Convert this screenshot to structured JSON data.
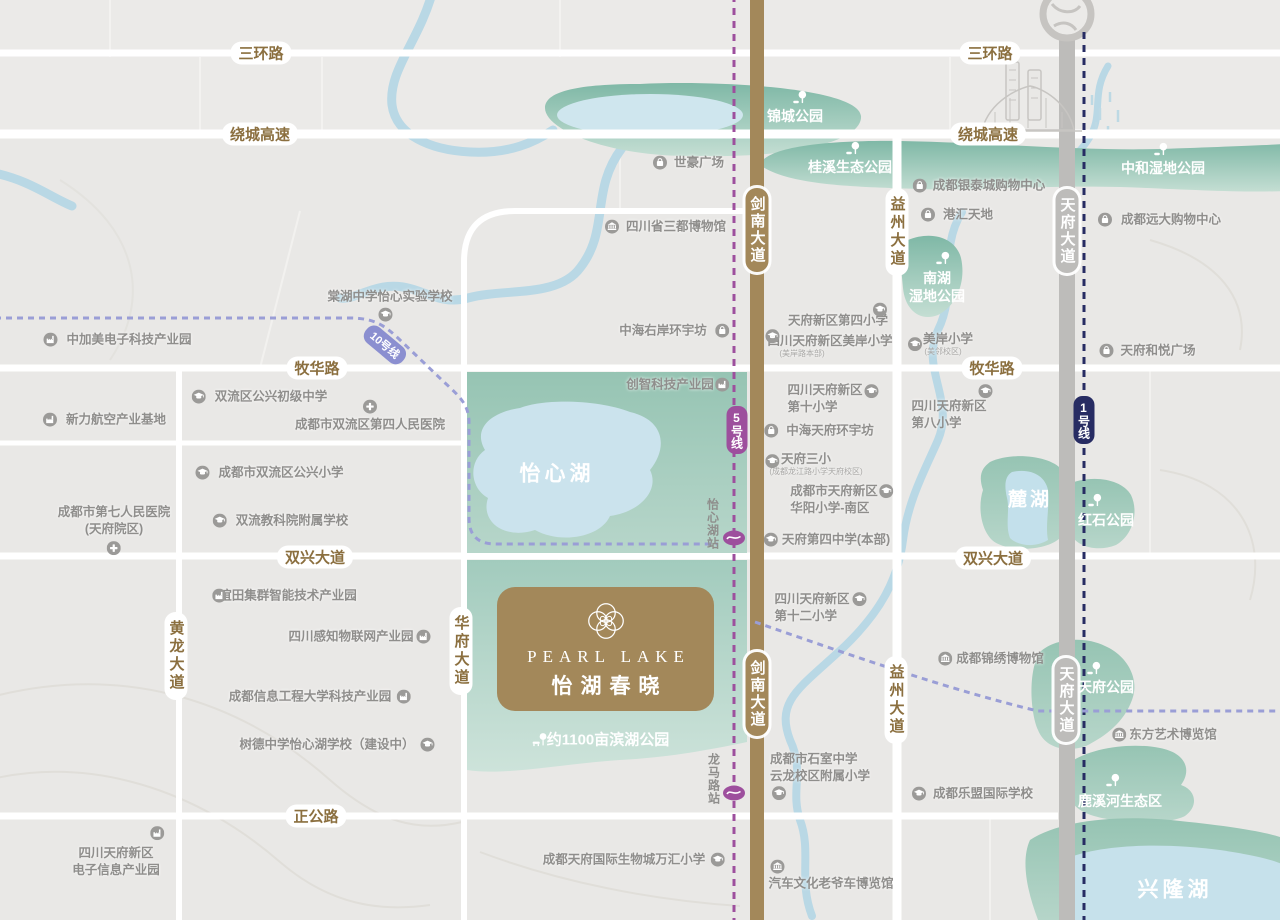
{
  "colors": {
    "background": "#e9e8e6",
    "road_white": "#ffffff",
    "avenue_brown": "#a3885a",
    "avenue_gray": "#bdbcba",
    "river": "#b9d8e5",
    "park_dark": "#7fb8a6",
    "park_light": "#c8e0d7",
    "lake": "#c9e2ec",
    "road_label_brown": "#8b6f3f",
    "poi_gray": "#8f8e8c",
    "metro_line5": "#9d4f9d",
    "metro_line1": "#272c63",
    "metro_line10": "#8b8fd0",
    "logo_bg": "#a3885a"
  },
  "logo": {
    "en": "PEARL LAKE",
    "cn": "怡湖春晓"
  },
  "road_labels": [
    {
      "text": "三环路",
      "x": 261,
      "y": 53,
      "o": "h"
    },
    {
      "text": "三环路",
      "x": 990,
      "y": 53,
      "o": "h"
    },
    {
      "text": "绕城高速",
      "x": 260,
      "y": 134,
      "o": "h"
    },
    {
      "text": "绕城高速",
      "x": 988,
      "y": 134,
      "o": "h"
    },
    {
      "text": "牧华路",
      "x": 317,
      "y": 368,
      "o": "h"
    },
    {
      "text": "牧华路",
      "x": 992,
      "y": 368,
      "o": "h"
    },
    {
      "text": "双兴大道",
      "x": 315,
      "y": 557,
      "o": "h"
    },
    {
      "text": "双兴大道",
      "x": 993,
      "y": 558,
      "o": "h"
    },
    {
      "text": "正公路",
      "x": 316,
      "y": 816,
      "o": "h"
    },
    {
      "text": "黄龙大道",
      "x": 176,
      "y": 656,
      "o": "v"
    },
    {
      "text": "华府大道",
      "x": 461,
      "y": 651,
      "o": "v"
    },
    {
      "text": "益州大道",
      "x": 897,
      "y": 232,
      "o": "v"
    },
    {
      "text": "益州大道",
      "x": 896,
      "y": 700,
      "o": "v"
    },
    {
      "text": "剑南大道",
      "x": 757,
      "y": 230,
      "o": "v",
      "road": "brown"
    },
    {
      "text": "剑南大道",
      "x": 757,
      "y": 694,
      "o": "v",
      "road": "brown"
    },
    {
      "text": "天府大道",
      "x": 1067,
      "y": 231,
      "o": "v",
      "road": "gray"
    },
    {
      "text": "天府大道",
      "x": 1066,
      "y": 700,
      "o": "v",
      "road": "gray"
    }
  ],
  "metro": {
    "badges": [
      {
        "text": "5号线",
        "x": 737,
        "y": 430,
        "color": "#9d4f9d",
        "mode": "v"
      },
      {
        "text": "1号线",
        "x": 1084,
        "y": 420,
        "color": "#272c63",
        "mode": "v"
      },
      {
        "text": "10号线",
        "x": 385,
        "y": 345,
        "color": "#8b8fd0",
        "mode": "rot",
        "rotate": 40
      }
    ],
    "stations": [
      {
        "name": "怡心湖站",
        "x": 734,
        "y": 538,
        "label_x": 713,
        "label_y": 524
      },
      {
        "name": "龙马路站",
        "x": 734,
        "y": 793,
        "label_x": 714,
        "label_y": 779
      }
    ]
  },
  "park_labels": [
    {
      "lines": [
        "锦城公园"
      ],
      "x": 795,
      "y": 116,
      "icon": "tree",
      "idx": 5,
      "idy": -18
    },
    {
      "lines": [
        "桂溪生态公园"
      ],
      "x": 850,
      "y": 167,
      "icon": "tree",
      "idx": 3,
      "idy": -18
    },
    {
      "lines": [
        "中和湿地公园"
      ],
      "x": 1163,
      "y": 168,
      "icon": "tree",
      "idx": -2,
      "idy": -18
    },
    {
      "lines": [
        "南湖",
        "湿地公园"
      ],
      "x": 937,
      "y": 287,
      "icon": "tree",
      "idx": 6,
      "idy": -28,
      "size": "s13"
    },
    {
      "lines": [
        "红石公园"
      ],
      "x": 1106,
      "y": 520,
      "icon": "tree",
      "idx": -11,
      "idy": -19
    },
    {
      "lines": [
        "天府公园"
      ],
      "x": 1106,
      "y": 687,
      "icon": "tree",
      "idx": -12,
      "idy": -18
    },
    {
      "lines": [
        "鹿溪河生态区"
      ],
      "x": 1120,
      "y": 801,
      "icon": "tree",
      "idx": -7,
      "idy": -20
    },
    {
      "lines": [
        "约1100亩滨湖公园"
      ],
      "x": 608,
      "y": 740,
      "icon": "benchtree",
      "idx": -68,
      "idy": 0,
      "size": "s15"
    },
    {
      "lines": [
        "怡心湖"
      ],
      "x": 557,
      "y": 474,
      "size": "s21"
    },
    {
      "lines": [
        "麓湖"
      ],
      "x": 1030,
      "y": 501,
      "size": "s19"
    },
    {
      "lines": [
        "兴隆湖"
      ],
      "x": 1175,
      "y": 890,
      "size": "s21"
    }
  ],
  "pois": [
    {
      "lines": [
        "世豪广场"
      ],
      "x": 699,
      "y": 163,
      "icon": "mall",
      "idx": -39,
      "idy": 0
    },
    {
      "lines": [
        "四川省三都博物馆"
      ],
      "x": 676,
      "y": 227,
      "icon": "museum",
      "idx": -64,
      "idy": 0
    },
    {
      "lines": [
        "中海右岸环宇坊"
      ],
      "x": 663,
      "y": 331,
      "icon": "mall",
      "idx": 59,
      "idy": 0
    },
    {
      "lines": [
        "创智科技产业园"
      ],
      "x": 670,
      "y": 385,
      "icon": "industry",
      "idx": 52,
      "idy": 0
    },
    {
      "lines": [
        "棠湖中学怡心实验学校"
      ],
      "x": 390,
      "y": 297,
      "icon": "school",
      "idx": -5,
      "idy": 18
    },
    {
      "lines": [
        "中加美电子科技产业园"
      ],
      "x": 129,
      "y": 340,
      "icon": "industry",
      "idx": -79,
      "idy": 0
    },
    {
      "lines": [
        "新力航空产业基地"
      ],
      "x": 116,
      "y": 420,
      "icon": "industry",
      "idx": -66,
      "idy": 0
    },
    {
      "lines": [
        "双流区公兴初级中学"
      ],
      "x": 271,
      "y": 397,
      "icon": "school",
      "idx": -72,
      "idy": 0
    },
    {
      "lines": [
        "成都市双流区第四人民医院"
      ],
      "x": 370,
      "y": 425,
      "icon": "hospital",
      "idx": 0,
      "idy": -18
    },
    {
      "lines": [
        "成都市双流区公兴小学"
      ],
      "x": 281,
      "y": 473,
      "icon": "school",
      "idx": -79,
      "idy": 0
    },
    {
      "lines": [
        "双流教科院附属学校"
      ],
      "x": 292,
      "y": 521,
      "icon": "school",
      "idx": -72,
      "idy": 0
    },
    {
      "lines": [
        "成都市第七人民医院",
        "(天府院区)"
      ],
      "x": 114,
      "y": 521,
      "icon": "hospital",
      "idx": 0,
      "idy": 27
    },
    {
      "lines": [
        "谊田集群智能技术产业园"
      ],
      "x": 288,
      "y": 596,
      "icon": "industry",
      "idx": -69,
      "idy": 0
    },
    {
      "lines": [
        "四川感知物联网产业园"
      ],
      "x": 351,
      "y": 637,
      "icon": "industry",
      "idx": 72,
      "idy": 0
    },
    {
      "lines": [
        "成都信息工程大学科技产业园"
      ],
      "x": 310,
      "y": 697,
      "icon": "industry",
      "idx": 94,
      "idy": 0
    },
    {
      "lines": [
        "树德中学怡心湖学校（建设中）"
      ],
      "x": 327,
      "y": 745,
      "icon": "school",
      "idx": 100,
      "idy": 0
    },
    {
      "lines": [
        "四川天府新区",
        "电子信息产业园"
      ],
      "x": 116,
      "y": 862,
      "icon": "industry",
      "idx": 41,
      "idy": -29
    },
    {
      "lines": [
        "天府新区第四小学"
      ],
      "x": 838,
      "y": 321,
      "icon": "school",
      "idx": 42,
      "idy": -11
    },
    {
      "lines": [
        "四川天府新区美岸小学"
      ],
      "sub": "(美岸路本部)",
      "sub_dx": -28,
      "x": 830,
      "y": 346,
      "icon": "school",
      "idx": -58,
      "idy": -10
    },
    {
      "lines": [
        "美岸小学"
      ],
      "sub": "(美邻校区)",
      "sub_dx": -5,
      "x": 948,
      "y": 344,
      "icon": "school",
      "idx": -33,
      "idy": 0
    },
    {
      "lines": [
        "四川天府新区",
        "第十小学"
      ],
      "x": 825,
      "y": 399,
      "align": "left",
      "icon": "school",
      "idx": 46,
      "idy": -8
    },
    {
      "lines": [
        "中海天府环宇坊"
      ],
      "x": 830,
      "y": 431,
      "icon": "mall",
      "idx": -59,
      "idy": 0
    },
    {
      "lines": [
        "天府三小"
      ],
      "sub": "(成都龙江路小学天府校区)",
      "sub_dx": 10,
      "x": 806,
      "y": 464,
      "icon": "school",
      "idx": -34,
      "idy": -3
    },
    {
      "lines": [
        "成都市天府新区",
        "华阳小学-南区"
      ],
      "x": 834,
      "y": 500,
      "align": "left",
      "icon": "school",
      "idx": 52,
      "idy": -9
    },
    {
      "lines": [
        "天府第四中学(本部)"
      ],
      "x": 836,
      "y": 540,
      "icon": "school",
      "idx": -65,
      "idy": 0
    },
    {
      "lines": [
        "四川天府新区",
        "第十二小学"
      ],
      "x": 812,
      "y": 608,
      "align": "left",
      "icon": "school",
      "idx": 47,
      "idy": -9
    },
    {
      "lines": [
        "四川天府新区",
        "第八小学"
      ],
      "x": 949,
      "y": 415,
      "align": "left",
      "icon": "school",
      "idx": 36,
      "idy": -24
    },
    {
      "lines": [
        "成都银泰城购物中心"
      ],
      "x": 989,
      "y": 186,
      "icon": "mall",
      "idx": -69,
      "idy": 0
    },
    {
      "lines": [
        "港汇天地"
      ],
      "x": 968,
      "y": 215,
      "icon": "mall",
      "idx": -40,
      "idy": 0
    },
    {
      "lines": [
        "成都远大购物中心"
      ],
      "x": 1171,
      "y": 220,
      "icon": "mall",
      "idx": -66,
      "idy": 0
    },
    {
      "lines": [
        "天府和悦广场"
      ],
      "x": 1158,
      "y": 351,
      "icon": "mall",
      "idx": -52,
      "idy": 0
    },
    {
      "lines": [
        "成都锦绣博物馆"
      ],
      "x": 1000,
      "y": 659,
      "icon": "museum",
      "idx": -55,
      "idy": 0
    },
    {
      "lines": [
        "东方艺术博览馆"
      ],
      "x": 1173,
      "y": 735,
      "icon": "museum",
      "idx": -54,
      "idy": 0
    },
    {
      "lines": [
        "成都乐盟国际学校"
      ],
      "x": 983,
      "y": 794,
      "icon": "school",
      "idx": -64,
      "idy": 0
    },
    {
      "lines": [
        "成都市石室中学",
        "云龙校区附属小学"
      ],
      "x": 820,
      "y": 768,
      "align": "left",
      "icon": "school",
      "idx": -41,
      "idy": 25
    },
    {
      "lines": [
        "成都天府国际生物城万汇小学"
      ],
      "x": 624,
      "y": 860,
      "icon": "school",
      "idx": 94,
      "idy": 0
    },
    {
      "lines": [
        "汽车文化老爷车博览馆"
      ],
      "x": 831,
      "y": 884,
      "icon": "museum",
      "idx": -54,
      "idy": -17
    }
  ]
}
